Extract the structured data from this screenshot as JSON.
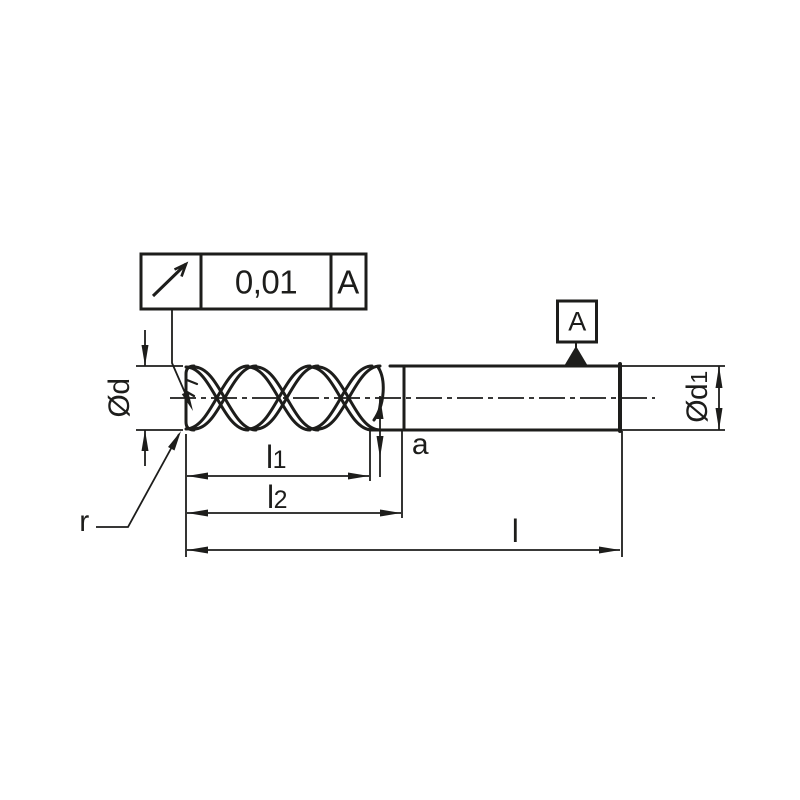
{
  "ink": "#1d1d1b",
  "tolerance_frame": {
    "symbol": "circular-runout",
    "value": "0,01",
    "datum_ref": "A"
  },
  "datum": {
    "label": "A"
  },
  "labels": {
    "cutting_diameter": {
      "base": "Ød",
      "sub": ""
    },
    "shank_diameter": {
      "base": "Ød",
      "sub": "1"
    },
    "flute_length": {
      "base": "l",
      "sub": "1"
    },
    "neck_length": {
      "base": "l",
      "sub": "2"
    },
    "overall_length": {
      "base": "l",
      "sub": ""
    },
    "tip_dimension": {
      "base": "a",
      "sub": ""
    },
    "corner_radius": {
      "base": "r",
      "sub": ""
    }
  }
}
